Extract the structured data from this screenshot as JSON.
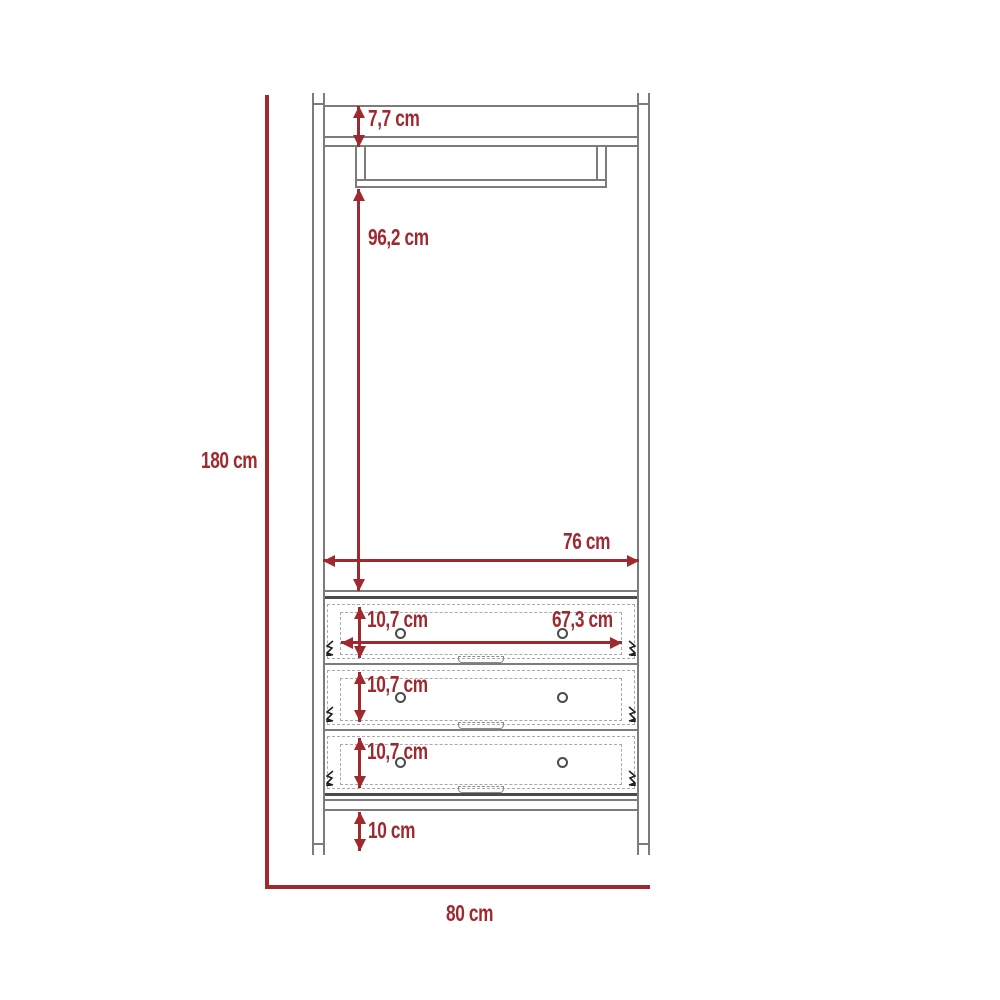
{
  "diagram": {
    "type": "furniture-dimension-drawing",
    "colors": {
      "dimension_red": "#9e2a2f",
      "outline_gray": "#7c7c7c",
      "dark_gray": "#4b4b4b",
      "dashed_gray": "#a9a9a9"
    },
    "dimensions": {
      "total_height": "180 cm",
      "total_width": "80 cm",
      "top_panel_thickness": "7,7 cm",
      "hanging_space_height": "96,2 cm",
      "interior_width": "76 cm",
      "drawer_front_width": "67,3 cm",
      "drawer_heights": [
        "10,7 cm",
        "10,7 cm",
        "10,7 cm"
      ],
      "leg_clearance": "10 cm"
    }
  }
}
